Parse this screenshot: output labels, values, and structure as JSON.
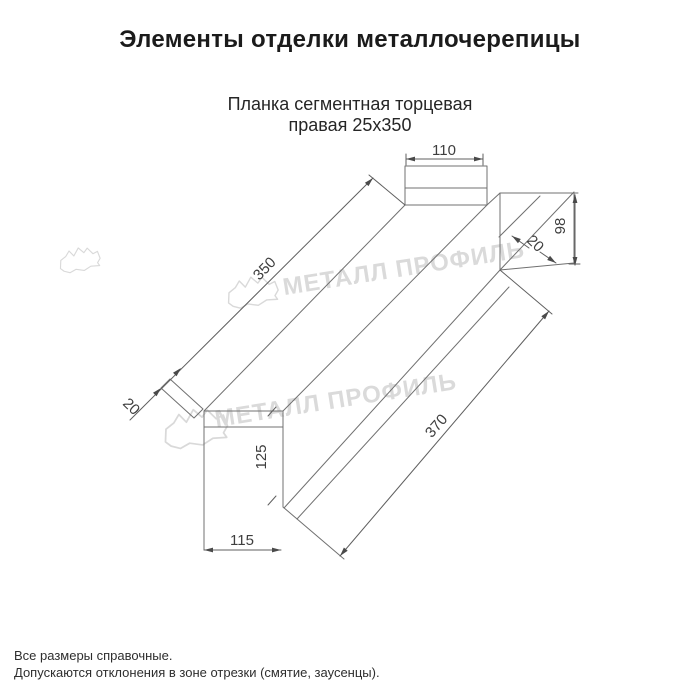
{
  "header": {
    "title": "Элементы отделки металлочерепицы"
  },
  "product": {
    "name_line1": "Планка сегментная торцевая",
    "name_line2": "правая 25x350"
  },
  "drawing": {
    "watermark_text": "МЕТАЛЛ ПРОФИЛЬ",
    "dimensions": {
      "flange_width_top": "110",
      "face_height_right": "98",
      "fold_right": "20",
      "length_top": "350",
      "fold_left": "20",
      "length_bottom": "370",
      "face_height_front": "125",
      "face_width_front": "115"
    },
    "colors": {
      "outline": "#707070",
      "dimension_text": "#3e3e3e",
      "watermark": "#dadada",
      "background": "#ffffff"
    }
  },
  "footer": {
    "note1": "Все размеры справочные.",
    "note2": "Допускаются отклонения в зоне отрезки (смятие, заусенцы)."
  }
}
